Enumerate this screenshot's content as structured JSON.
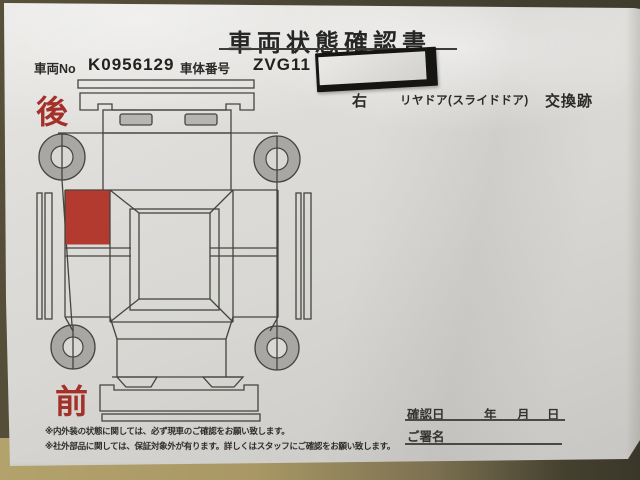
{
  "doc": {
    "title": "車両状態確認書",
    "vehicle_no_label": "車両No",
    "vehicle_no": "K0956129",
    "body_no_label": "車体番号",
    "body_no_visible": "ZVG11",
    "damage": {
      "side": "右",
      "part": "リヤドア(スライドドア)",
      "finding": "交換跡"
    },
    "diagram": {
      "rear_label": "後",
      "front_label": "前",
      "marked_panel": "right-rear-slide-door",
      "mark_color": "#b23a2e"
    },
    "confirm": {
      "date_label": "確認日",
      "year_label": "年",
      "month_label": "月",
      "day_label": "日",
      "sign_label": "ご署名"
    },
    "notes": [
      "※内外装の状態に関しては、必ず現車のご確認をお願い致します。",
      "※社外部品に関しては、保証対象外が有ります。詳しくはスタッフにご確認をお願い致します。"
    ]
  }
}
